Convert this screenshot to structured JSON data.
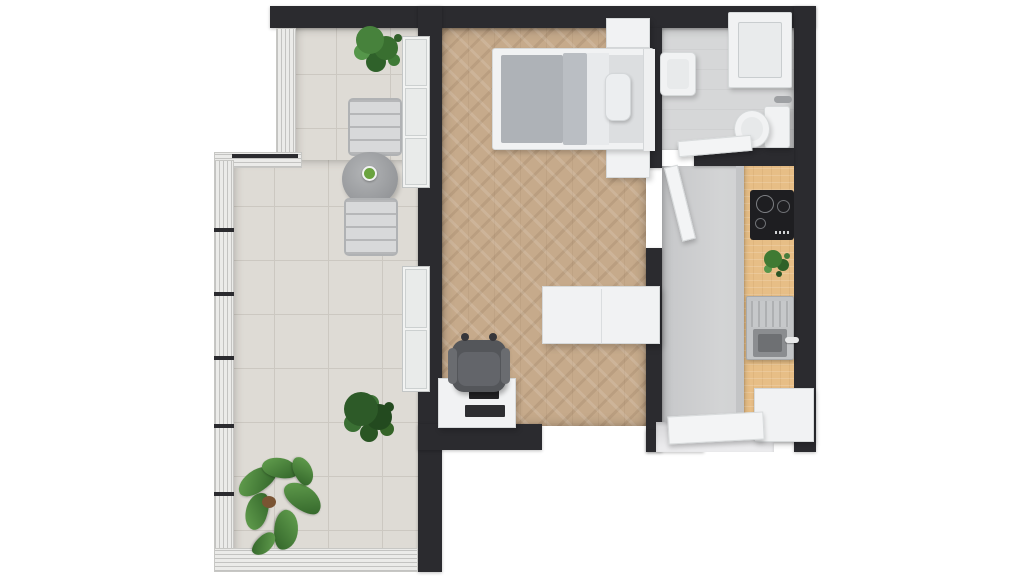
{
  "scene": {
    "title": "Studio apartment floor plan – 3D top view",
    "description": "Photorealistic top-down 3D rendering of a studio apartment with a tiled balcony, living/bedroom area with herringbone parquet, bathroom and a kitchen hallway",
    "background": "#ffffff"
  },
  "palette": {
    "wall": "#2b2b2f",
    "balcony_tile": "#dedbd5",
    "parquet_wood": "#c6aa8b",
    "bathroom_floor": "#d6d7d8",
    "hall_floor": "#cdcecf",
    "counter_wood": "#e7be86",
    "furniture_white": "#f1f2f3",
    "textile_gray": "#b2b6bb",
    "armchair_gray": "#54565a",
    "appliance_black": "#1e1e21",
    "plant_green": "#3f7a33"
  },
  "rooms": {
    "balcony": {
      "label": "Balcony",
      "floor": "light gray ceramic tiles",
      "items": {
        "plant_top": "Potted green plant",
        "chair_top": "Metal bistro chair",
        "table": "Round bistro table",
        "table_plant": "Small plant in white pot",
        "chair_bottom": "Metal bistro chair",
        "shrub": "Green shrub",
        "leaf_plant": "Large leafy plant",
        "railing": "Glass balcony railing"
      }
    },
    "living": {
      "label": "Living / bedroom",
      "floor": "herringbone oak parquet",
      "items": {
        "bed": "Double bed with gray duvet and pillow",
        "nightstand_top": "Nightstand",
        "nightstand_bottom": "Nightstand",
        "wardrobe": "White wardrobe",
        "armchair": "Gray armchair",
        "tv_stand": "TV stand with television",
        "window_upper": "Balcony window",
        "window_lower": "Balcony window",
        "door": "Open interior door"
      }
    },
    "bathroom": {
      "label": "Bathroom",
      "floor": "gray tiles",
      "items": {
        "shower": "Shower tray",
        "basin": "Washbasin",
        "toilet": "Toilet with cistern",
        "door": "Open bathroom door",
        "handle": "Wall-mounted handle"
      }
    },
    "hallway_kitchen": {
      "label": "Hallway with kitchenette",
      "floor": "gray tiles",
      "items": {
        "counter": "Wooden kitchen countertop",
        "cooktop": "Black induction cooktop",
        "plant": "Potted herb",
        "sink": "Stainless steel sink with drainer",
        "cabinet": "White base cabinet",
        "entry_door": "Open entry door",
        "threshold": "Entry threshold"
      }
    }
  }
}
